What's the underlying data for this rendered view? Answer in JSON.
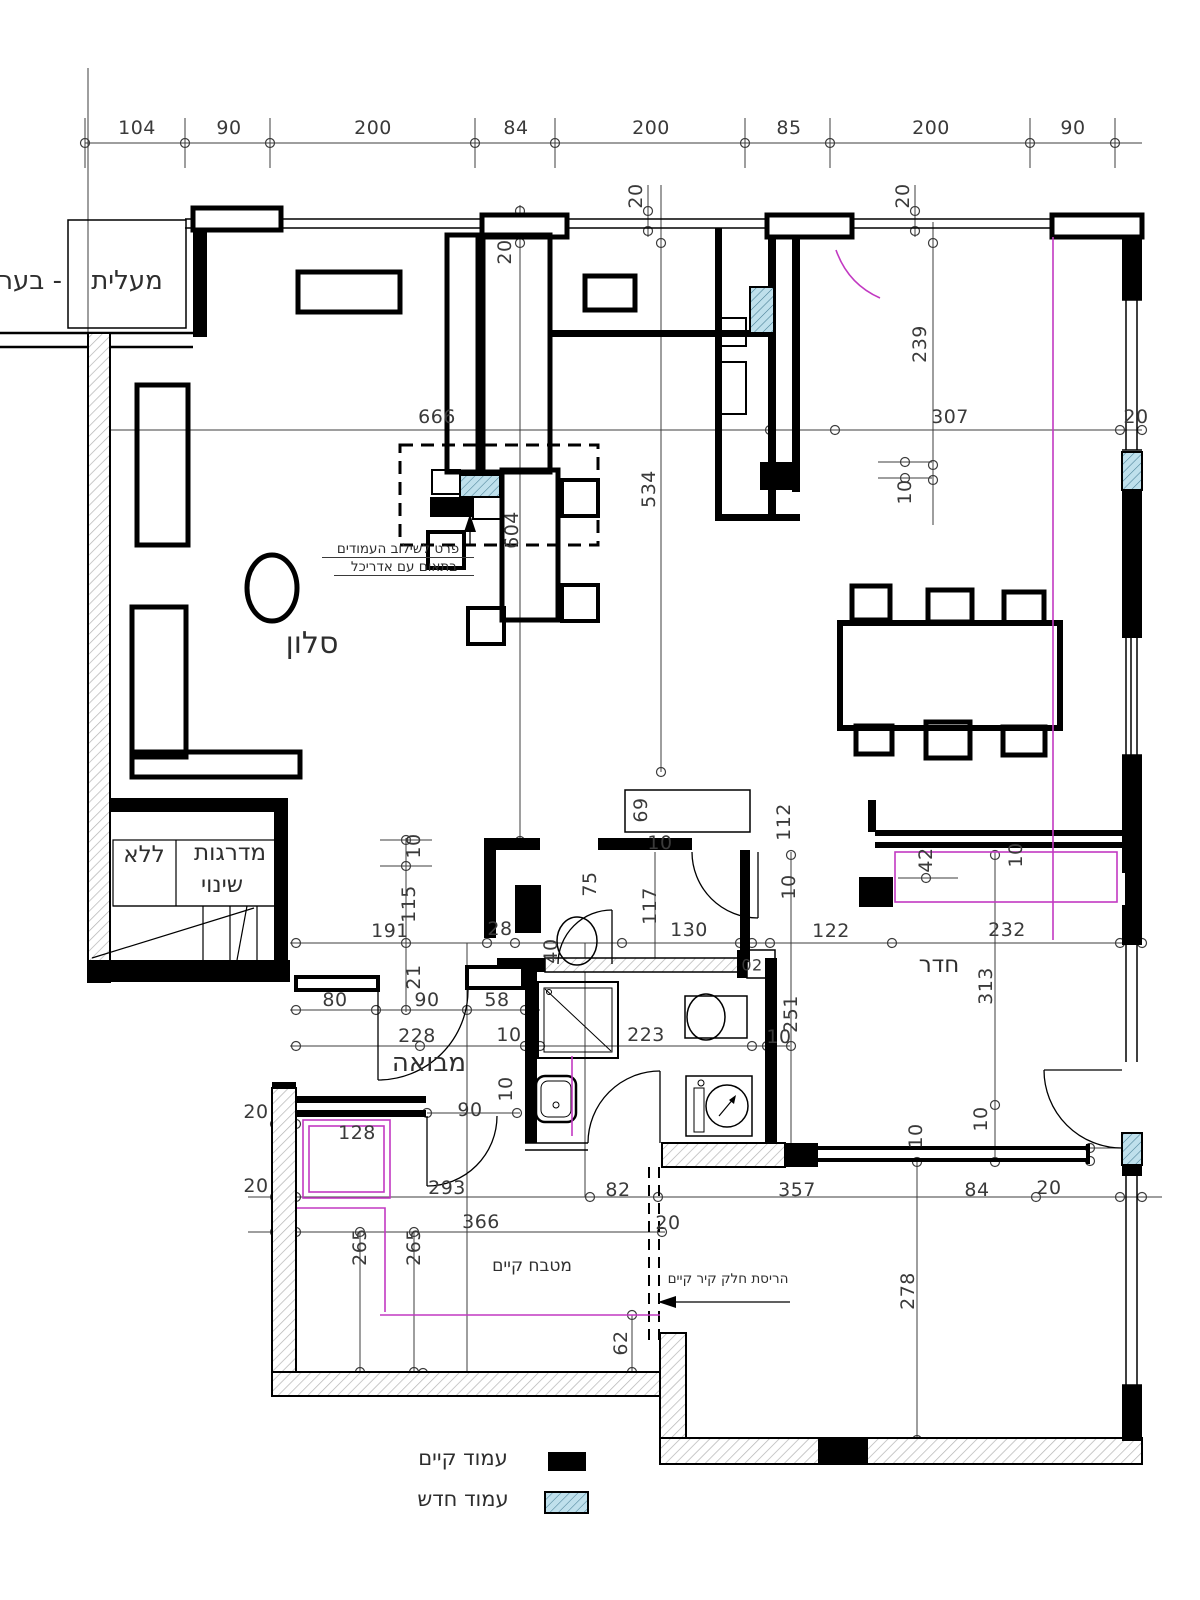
{
  "rooms": {
    "elevator": "מעלית",
    "elevator_cont": "- בער",
    "salon": "סלון",
    "stairs_word": "מדרגות",
    "stairs_no": "ללא",
    "stairs_change": "שינוי",
    "entry": "מבואה",
    "room": "חדר",
    "kitchen": "מטבח קיים"
  },
  "notes": {
    "columns_note_1": "פרט לשילוב העמודים",
    "columns_note_2": "בתאום עם אדריכל",
    "demolition": "הריסת חלק קיר קיים"
  },
  "legend": {
    "existing_column": "עמוד קיים",
    "new_column": "עמוד חדש"
  },
  "colors": {
    "line": "#000000",
    "dim_text": "#3a3a3a",
    "magenta": "#c239c2",
    "new_column_fill": "#bfe0ec",
    "new_column_hatch": "#477f95",
    "wall_hatch": "#b3b3b3"
  },
  "top_dimensions": [
    "104",
    "90",
    "200",
    "84",
    "200",
    "85",
    "200",
    "90"
  ],
  "dim_labels": [
    {
      "t": "104",
      "x": 137,
      "y": 128
    },
    {
      "t": "90",
      "x": 229,
      "y": 128
    },
    {
      "t": "200",
      "x": 373,
      "y": 128
    },
    {
      "t": "84",
      "x": 516,
      "y": 128
    },
    {
      "t": "200",
      "x": 651,
      "y": 128
    },
    {
      "t": "85",
      "x": 789,
      "y": 128
    },
    {
      "t": "200",
      "x": 931,
      "y": 128
    },
    {
      "t": "90",
      "x": 1073,
      "y": 128
    },
    {
      "t": "20",
      "x": 505,
      "y": 252,
      "r": 1
    },
    {
      "t": "20",
      "x": 636,
      "y": 196,
      "r": 1
    },
    {
      "t": "20",
      "x": 903,
      "y": 196,
      "r": 1
    },
    {
      "t": "666",
      "x": 437,
      "y": 417
    },
    {
      "t": "604",
      "x": 512,
      "y": 530,
      "r": 1
    },
    {
      "t": "534",
      "x": 649,
      "y": 489,
      "r": 1
    },
    {
      "t": "239",
      "x": 920,
      "y": 344,
      "r": 1
    },
    {
      "t": "307",
      "x": 950,
      "y": 417
    },
    {
      "t": "20",
      "x": 1136,
      "y": 417
    },
    {
      "t": "10",
      "x": 905,
      "y": 492,
      "r": 1
    },
    {
      "t": "69",
      "x": 641,
      "y": 810,
      "r": 1
    },
    {
      "t": "10",
      "x": 660,
      "y": 843
    },
    {
      "t": "112",
      "x": 784,
      "y": 822,
      "r": 1
    },
    {
      "t": "10",
      "x": 414,
      "y": 846,
      "r": 1
    },
    {
      "t": "115",
      "x": 409,
      "y": 904,
      "r": 1
    },
    {
      "t": "191",
      "x": 390,
      "y": 931
    },
    {
      "t": "28",
      "x": 500,
      "y": 929
    },
    {
      "t": "40",
      "x": 551,
      "y": 951,
      "r": 1
    },
    {
      "t": "75",
      "x": 590,
      "y": 884,
      "r": 1
    },
    {
      "t": "117",
      "x": 650,
      "y": 906,
      "r": 1
    },
    {
      "t": "130",
      "x": 689,
      "y": 930
    },
    {
      "t": "10",
      "x": 789,
      "y": 887,
      "r": 1
    },
    {
      "t": "122",
      "x": 831,
      "y": 931
    },
    {
      "t": "232",
      "x": 1007,
      "y": 930
    },
    {
      "t": "42",
      "x": 926,
      "y": 860,
      "r": 1
    },
    {
      "t": "10",
      "x": 1016,
      "y": 855,
      "r": 1
    },
    {
      "t": "80",
      "x": 335,
      "y": 1000
    },
    {
      "t": "21",
      "x": 414,
      "y": 977,
      "r": 1
    },
    {
      "t": "90",
      "x": 427,
      "y": 1000
    },
    {
      "t": "58",
      "x": 497,
      "y": 1000
    },
    {
      "t": "228",
      "x": 417,
      "y": 1036
    },
    {
      "t": "10",
      "x": 509,
      "y": 1035
    },
    {
      "t": "223",
      "x": 646,
      "y": 1035
    },
    {
      "t": "10",
      "x": 779,
      "y": 1037
    },
    {
      "t": "251",
      "x": 791,
      "y": 1014,
      "r": 1
    },
    {
      "t": "313",
      "x": 986,
      "y": 986,
      "r": 1
    },
    {
      "t": "02",
      "x": 752,
      "y": 965,
      "fs": 16
    },
    {
      "t": "90",
      "x": 470,
      "y": 1110
    },
    {
      "t": "10",
      "x": 506,
      "y": 1089,
      "r": 1
    },
    {
      "t": "20",
      "x": 256,
      "y": 1112
    },
    {
      "t": "20",
      "x": 256,
      "y": 1186
    },
    {
      "t": "128",
      "x": 357,
      "y": 1133
    },
    {
      "t": "293",
      "x": 447,
      "y": 1188
    },
    {
      "t": "82",
      "x": 618,
      "y": 1190
    },
    {
      "t": "357",
      "x": 797,
      "y": 1190
    },
    {
      "t": "84",
      "x": 977,
      "y": 1190
    },
    {
      "t": "20",
      "x": 1049,
      "y": 1188
    },
    {
      "t": "366",
      "x": 481,
      "y": 1222
    },
    {
      "t": "265",
      "x": 360,
      "y": 1247,
      "r": 1
    },
    {
      "t": "265",
      "x": 414,
      "y": 1247,
      "r": 1
    },
    {
      "t": "20",
      "x": 668,
      "y": 1223
    },
    {
      "t": "62",
      "x": 621,
      "y": 1343,
      "r": 1
    },
    {
      "t": "278",
      "x": 908,
      "y": 1291,
      "r": 1
    },
    {
      "t": "10",
      "x": 916,
      "y": 1136,
      "r": 1
    },
    {
      "t": "10",
      "x": 981,
      "y": 1119,
      "r": 1
    }
  ]
}
